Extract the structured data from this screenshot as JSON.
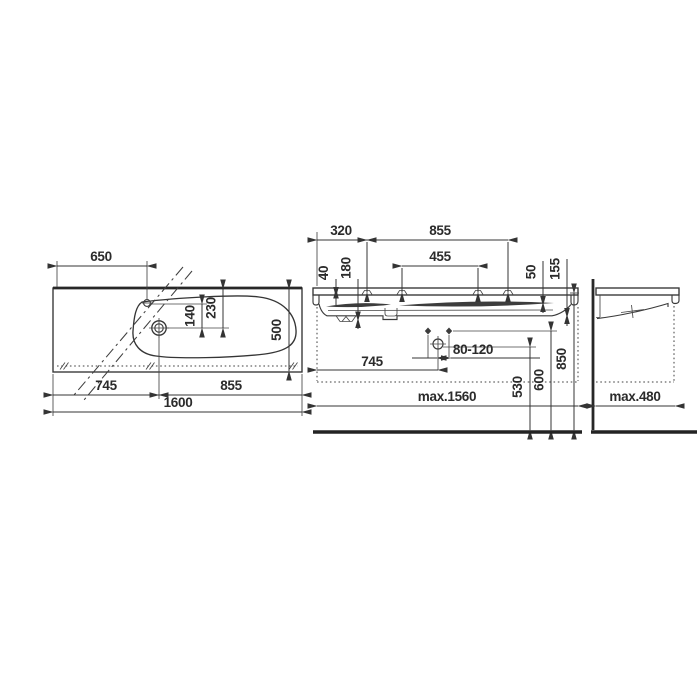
{
  "drawing": {
    "kind": "washbasin technical dimension drawing",
    "colors": {
      "line": "#3a3a3a",
      "text": "#2b2b2b",
      "background": "#ffffff"
    }
  },
  "views": {
    "plan": {
      "labels": {
        "hole_offset": "650",
        "hole_to_tap": "140",
        "rim_to_tap": "230",
        "depth": "500",
        "tap_from_left": "745",
        "right_section": "855",
        "total_width": "1600"
      }
    },
    "front": {
      "labels": {
        "left_to_first_hole": "320",
        "holes_span": "855",
        "inner_holes_span": "455",
        "front_rim_drop": "40",
        "basin_depth": "180",
        "right_rim_drop": "50",
        "edge_height": "155",
        "drain_from_left": "745",
        "drain_to_fixing": "80-120",
        "drain_height": "530",
        "fixing_height": "600",
        "rim_height": "850",
        "max_unit_width": "max.1560"
      }
    },
    "side": {
      "labels": {
        "max_unit_depth": "max.480"
      }
    }
  }
}
